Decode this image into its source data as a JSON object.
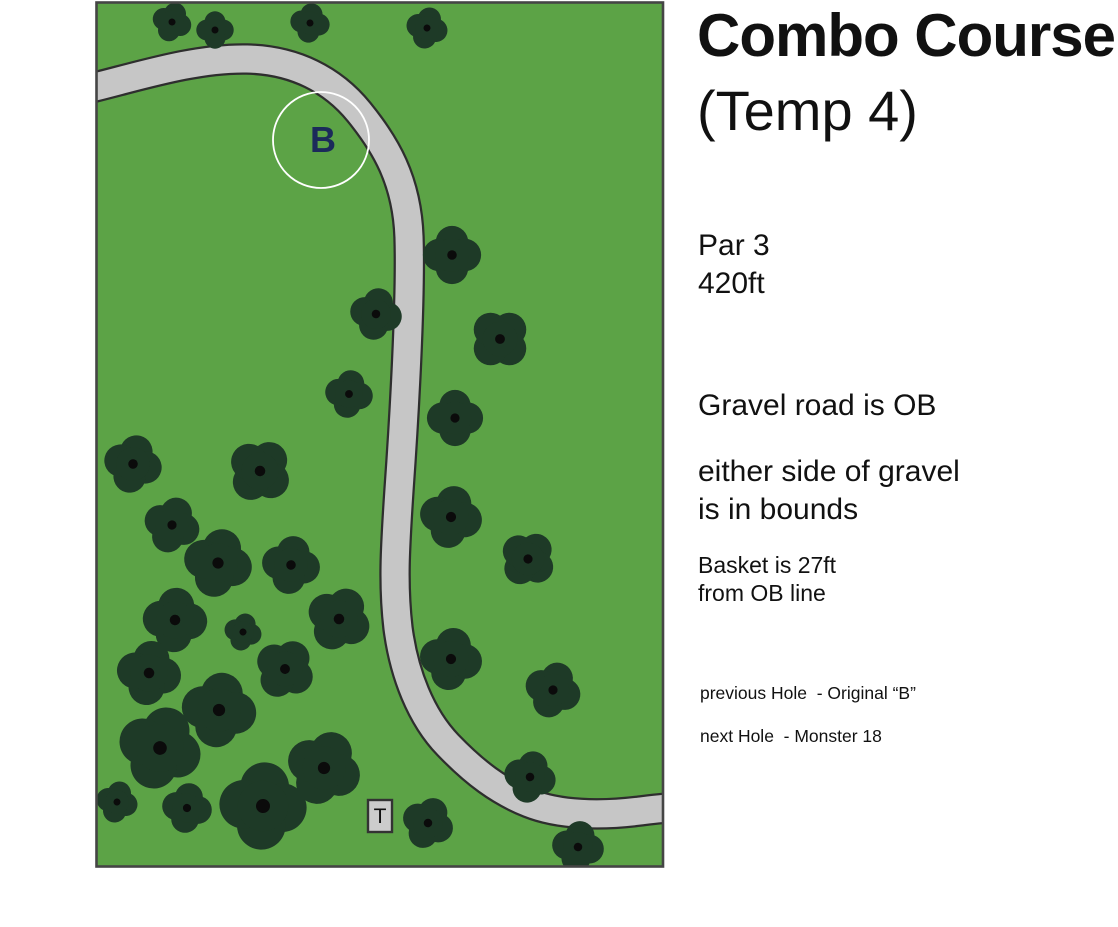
{
  "info_panel": {
    "title": "Combo Course",
    "subtitle": "(Temp 4)",
    "par": "Par 3",
    "distance": "420ft",
    "rule_gravel": "Gravel road is OB",
    "rule_bounds_line1": "either side of gravel",
    "rule_bounds_line2": "is in bounds",
    "basket_note_line1": "Basket is 27ft",
    "basket_note_line2": "from OB line",
    "previous_hole": "previous Hole  - Original “B”",
    "next_hole": "next Hole  - Monster 18"
  },
  "map": {
    "colors": {
      "field": "#5ca346",
      "tree": "#1e3a27",
      "tree_dot": "#0b0b0b",
      "road": "#c6c6c6",
      "road_edge": "#2e2e2e",
      "border": "#454545",
      "basket_ring": "#ffffff",
      "basket_text": "#1b2a5a",
      "tee_fill": "#cccccc",
      "tee_edge": "#333333",
      "tee_text": "#111111"
    },
    "road": {
      "centerline": "M -8 89 C 45 76 100 58 152 59 C 200 60 238 80 264 112 C 290 144 312 180 314 237 C 316 300 309 420 304 490 C 300 550 298 585 303 628 C 309 674 326 717 353 745 C 380 773 404 791 434 803 C 464 815 505 816 545 811 C 562 809 578 807 592 807",
      "width": 27
    },
    "basket": {
      "label": "B",
      "x": 226,
      "y": 140,
      "r": 48
    },
    "tee": {
      "label": "T",
      "x": 273,
      "y": 800,
      "w": 24,
      "h": 32
    },
    "trees": [
      {
        "x": 77,
        "y": 22,
        "r": 19,
        "rot": 20
      },
      {
        "x": 120,
        "y": 30,
        "r": 18,
        "rot": 0
      },
      {
        "x": 215,
        "y": 23,
        "r": 19,
        "rot": 10
      },
      {
        "x": 332,
        "y": 28,
        "r": 20,
        "rot": 15
      },
      {
        "x": 357,
        "y": 255,
        "r": 28,
        "rot": 0
      },
      {
        "x": 281,
        "y": 314,
        "r": 25,
        "rot": 12
      },
      {
        "x": 405,
        "y": 339,
        "r": 29,
        "rot": 45
      },
      {
        "x": 254,
        "y": 394,
        "r": 23,
        "rot": 10
      },
      {
        "x": 360,
        "y": 418,
        "r": 27,
        "rot": 0
      },
      {
        "x": 38,
        "y": 464,
        "r": 28,
        "rot": 15
      },
      {
        "x": 165,
        "y": 471,
        "r": 31,
        "rot": 40
      },
      {
        "x": 77,
        "y": 525,
        "r": 27,
        "rot": 20
      },
      {
        "x": 356,
        "y": 517,
        "r": 30,
        "rot": 12
      },
      {
        "x": 433,
        "y": 559,
        "r": 27,
        "rot": 40
      },
      {
        "x": 123,
        "y": 563,
        "r": 33,
        "rot": 15
      },
      {
        "x": 196,
        "y": 565,
        "r": 28,
        "rot": 10
      },
      {
        "x": 80,
        "y": 620,
        "r": 31,
        "rot": 5
      },
      {
        "x": 148,
        "y": 632,
        "r": 18,
        "rot": 15
      },
      {
        "x": 244,
        "y": 619,
        "r": 31,
        "rot": 30
      },
      {
        "x": 54,
        "y": 673,
        "r": 31,
        "rot": 10
      },
      {
        "x": 190,
        "y": 669,
        "r": 29,
        "rot": 35
      },
      {
        "x": 124,
        "y": 710,
        "r": 36,
        "rot": 10
      },
      {
        "x": 65,
        "y": 748,
        "r": 40,
        "rot": 20
      },
      {
        "x": 22,
        "y": 802,
        "r": 20,
        "rot": 15
      },
      {
        "x": 92,
        "y": 808,
        "r": 24,
        "rot": 10
      },
      {
        "x": 168,
        "y": 806,
        "r": 42,
        "rot": 5
      },
      {
        "x": 229,
        "y": 768,
        "r": 36,
        "rot": 25
      },
      {
        "x": 356,
        "y": 659,
        "r": 30,
        "rot": 10
      },
      {
        "x": 458,
        "y": 690,
        "r": 27,
        "rot": 20
      },
      {
        "x": 435,
        "y": 777,
        "r": 25,
        "rot": 15
      },
      {
        "x": 333,
        "y": 823,
        "r": 25,
        "rot": 25
      },
      {
        "x": 483,
        "y": 847,
        "r": 25,
        "rot": 10
      }
    ]
  }
}
